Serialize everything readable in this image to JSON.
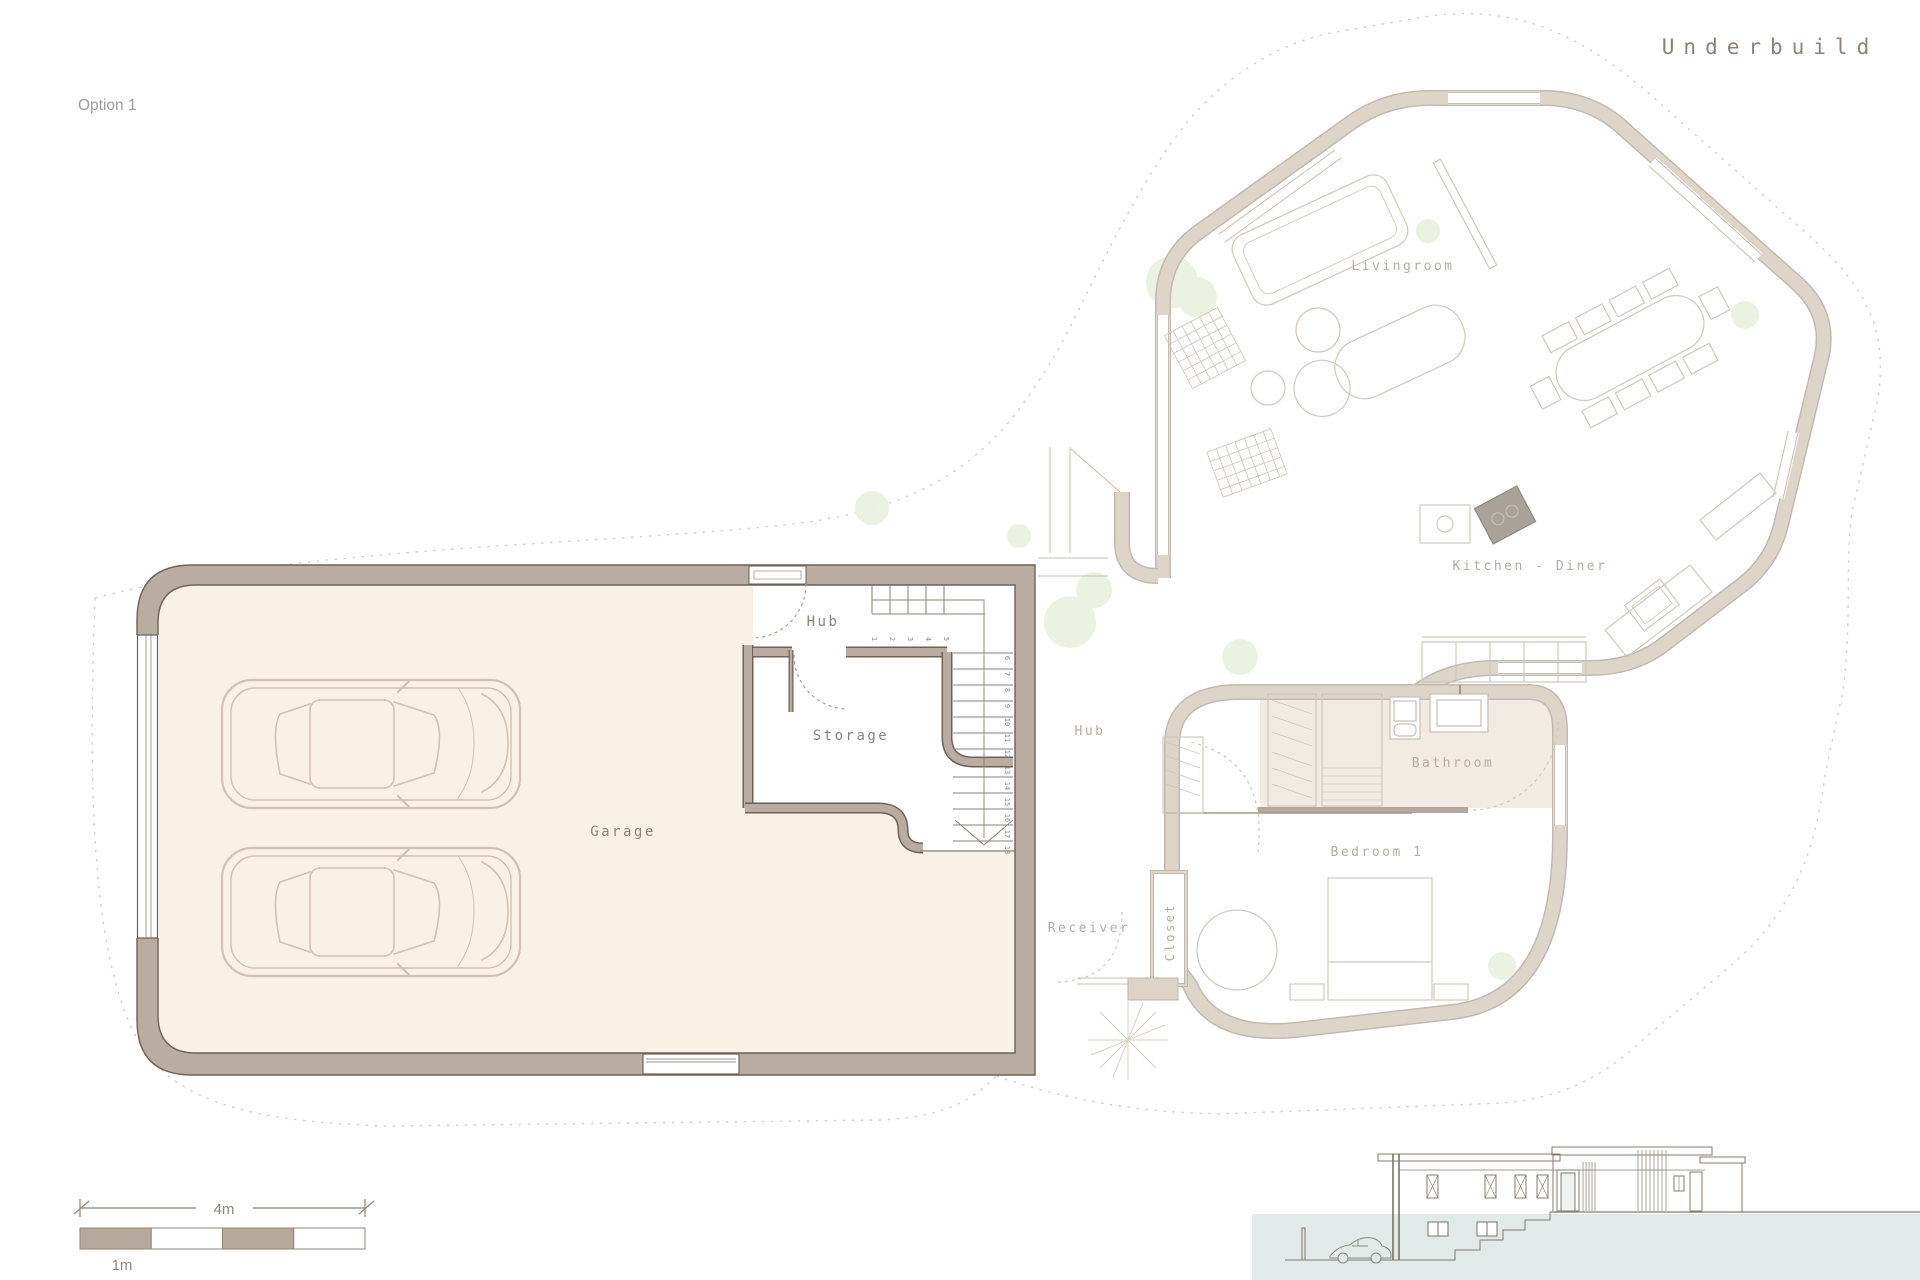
{
  "title": "Underbuild",
  "option_label": "Option 1",
  "lower_plan": {
    "garage": "Garage",
    "hub": "Hub",
    "storage": "Storage",
    "stairs": {
      "run1": [
        "1",
        "2",
        "3",
        "4",
        "5"
      ],
      "run2": [
        "6",
        "7",
        "8",
        "9",
        "10",
        "11",
        "12",
        "13",
        "14",
        "15",
        "16",
        "17",
        "18"
      ]
    }
  },
  "upper_plan": {
    "livingroom": "Livingroom",
    "kitchen": "Kitchen - Diner",
    "hub": "Hub",
    "bathroom": "Bathroom",
    "bedroom": "Bedroom 1",
    "receiver": "Receiver",
    "closet": "Closet"
  },
  "scale_bar": {
    "total": "4m",
    "unit": "1m"
  },
  "colors": {
    "wall_line": "#6e6257",
    "wall_fill": "#b9aca0",
    "floor": "#faf1e5",
    "faded_wall": "#ded5c9",
    "faded_edge": "#c2bab0",
    "thin_line": "#c6bfb4",
    "label": "#8b8174",
    "label_faded": "#b5ada1",
    "ground": "#e1eae8",
    "elevation_line": "#847b6f",
    "plant": "#eaf1df",
    "boundary": "#d6cfc4"
  }
}
